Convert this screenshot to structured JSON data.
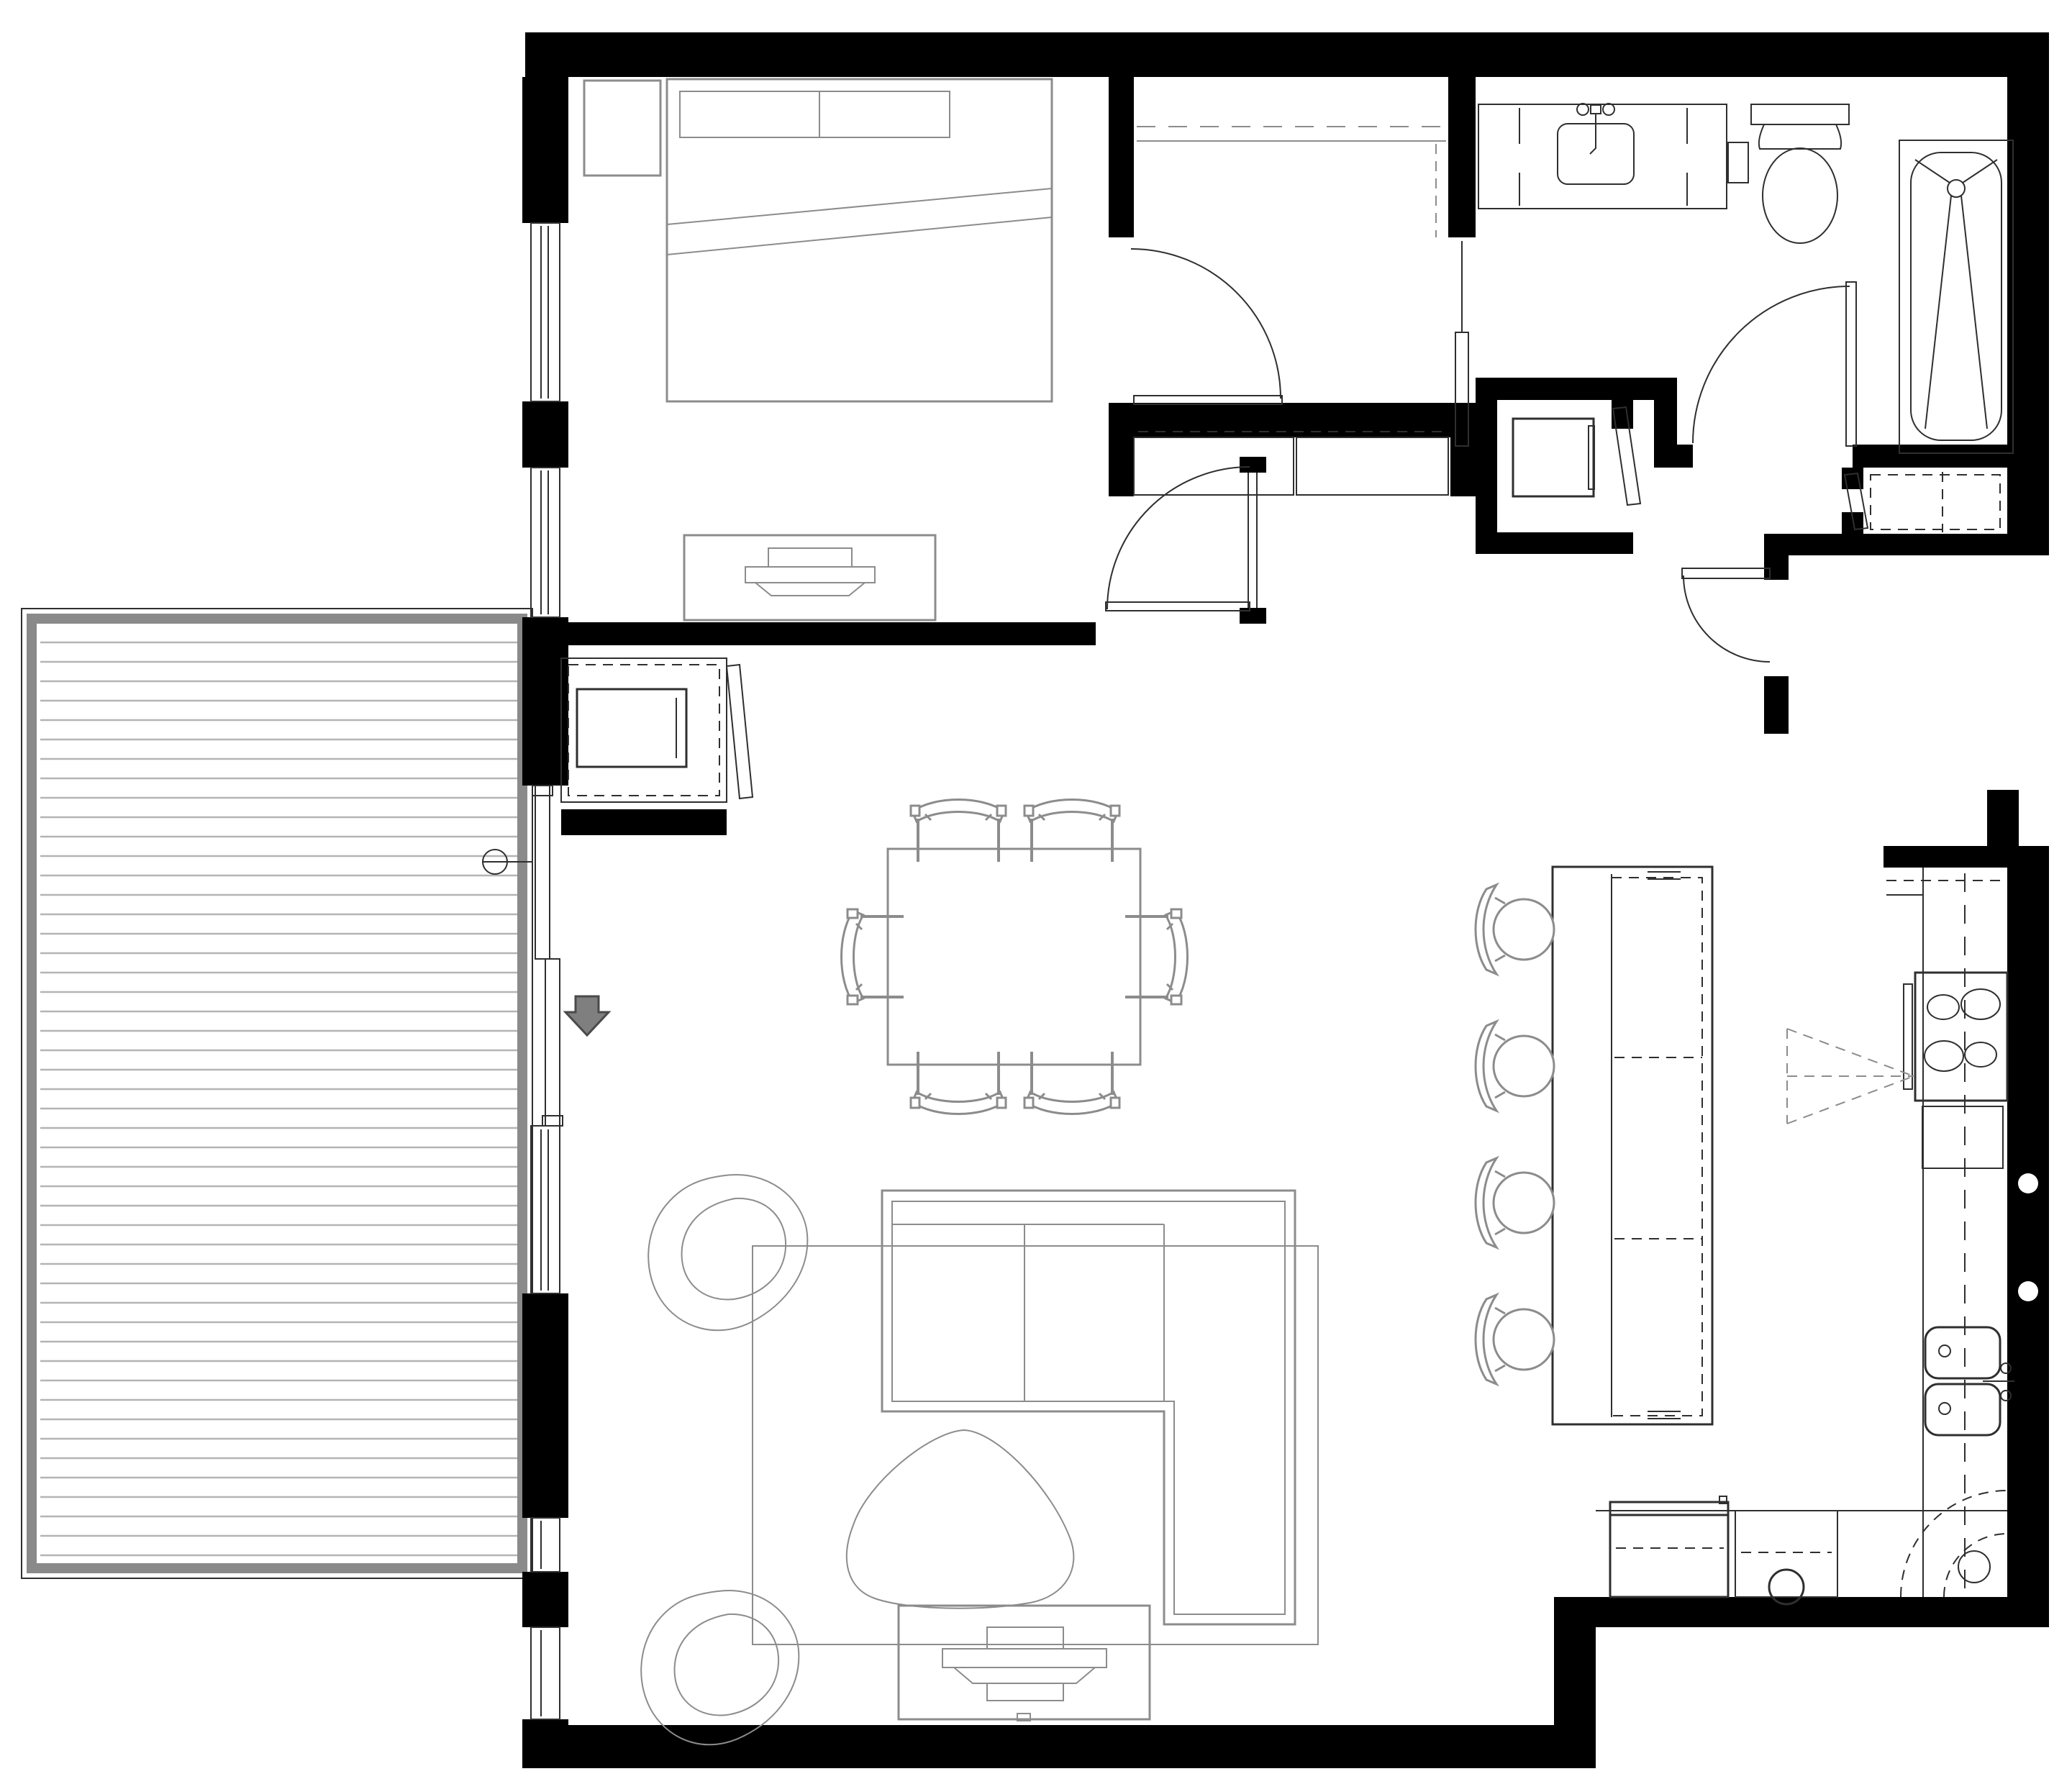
{
  "document": {
    "kind": "architectural floor plan drawing",
    "style": "black-and-white CAD line drawing, top-down view",
    "visible_text": "",
    "scale_or_dimensions_shown": false
  },
  "palette": {
    "background": "#ffffff",
    "wall": "#000000",
    "fixline": "#2f2f2f",
    "furnline": "#8c8c8c",
    "railing": "#8a8a8a",
    "deckline": "#b4b4b4",
    "arrow": "#7f7f7f"
  },
  "spaces": [
    {
      "name": "bedroom",
      "features": [
        "queen-bed-with-two-pillows",
        "nightstand",
        "dresser-with-tv",
        "window-wall-left",
        "swing-door"
      ]
    },
    {
      "name": "walk-in-closet",
      "features": [
        "hanging-rod-dashed",
        "shelf-line",
        "swing-door",
        "pocket-slider-to-bath-hall"
      ]
    },
    {
      "name": "bathroom",
      "features": [
        "vanity-with-sink",
        "toilet",
        "bathtub",
        "swing-door"
      ]
    },
    {
      "name": "laundry-closet",
      "features": [
        "stacked-washer-dryer",
        "angled-closet-door"
      ]
    },
    {
      "name": "linen-closet",
      "features": [
        "dashed-shelving",
        "angled-closet-door"
      ]
    },
    {
      "name": "entry",
      "features": [
        "entry-swing-door",
        "vestibule"
      ]
    },
    {
      "name": "kitchen",
      "features": [
        "cooktop-4-burners",
        "oven",
        "hood-dashed-symbol",
        "double-sink",
        "refrigerator",
        "dishwasher",
        "corner-lazy-susan",
        "island-with-overhang"
      ]
    },
    {
      "name": "dining-area",
      "features": [
        "rectangular-table",
        "six-chairs"
      ]
    },
    {
      "name": "living-room",
      "features": [
        "l-shaped-sectional-sofa",
        "two-organic-lounge-chairs",
        "organic-coffee-table",
        "area-rug",
        "media-console-with-tv"
      ]
    },
    {
      "name": "balcony",
      "features": [
        "deck-boards",
        "perimeter-railing",
        "sliding-glass-door",
        "hose-bib-handle"
      ]
    }
  ],
  "counts": {
    "bar_stools": 4,
    "dining_chairs": 6,
    "cooktop_burners": 4,
    "sink_bowls": 2,
    "balcony_deck_board_spacing_px": 27,
    "lounge_chairs": 2,
    "swing_doors": 5,
    "sliding_doors": 2,
    "angled_closet_doors": 3
  },
  "symbols": {
    "entry_direction_arrow": "gray downward arrow beside balcony slider",
    "wall_dots": "two white circles in right kitchen wall",
    "hood_symbol": "dashed triangle at cooktop",
    "lazy_susan": "dashed quarter arcs in kitchen corner"
  }
}
